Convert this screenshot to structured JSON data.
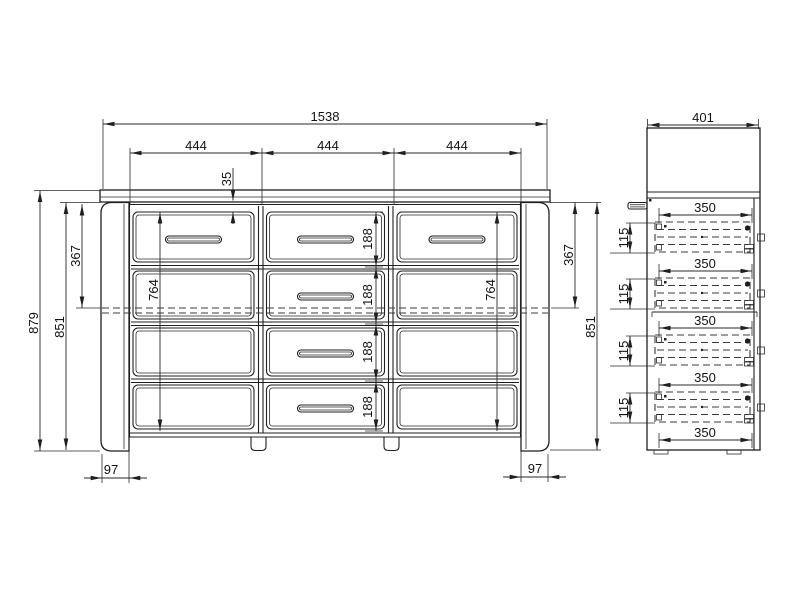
{
  "front_view": {
    "width_total": "1538",
    "col_widths": [
      "444",
      "444",
      "444"
    ],
    "top_gap": "35",
    "height_total": "879",
    "drawer_heights": [
      "188",
      "188",
      "188",
      "188"
    ],
    "left": {
      "panel_height": "851",
      "top_offset": "367",
      "column_height": "764",
      "foot_width": "97"
    },
    "right": {
      "panel_height": "851",
      "top_offset": "367",
      "column_height": "764",
      "foot_width": "97"
    }
  },
  "side_view": {
    "depth_total": "401",
    "drawer_depths": [
      "350",
      "350",
      "350",
      "350",
      "350"
    ],
    "drawer_heights": [
      "115",
      "115",
      "115",
      "115"
    ]
  }
}
